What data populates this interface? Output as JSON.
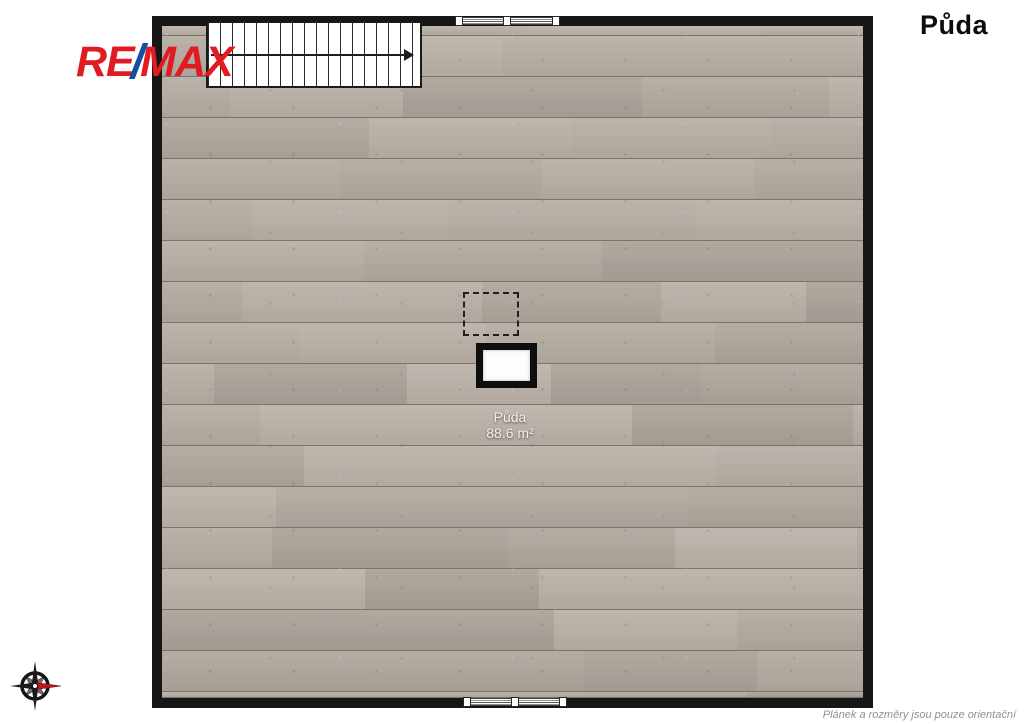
{
  "page": {
    "background": "#ffffff"
  },
  "header": {
    "title": "Půda"
  },
  "logo": {
    "re": "RE",
    "slash": "/",
    "max": "MAX",
    "color_red": "#e11b22",
    "color_blue": "#1450a0"
  },
  "room": {
    "name": "Půda",
    "area": "88.6 m²"
  },
  "floorplan": {
    "wall_color": "#161616",
    "floor_color": "#b3aba1",
    "plank_palette": [
      "#b7afa5",
      "#b2aaa0",
      "#b9b1a7",
      "#afa79d",
      "#b5ada3",
      "#bbb3a9",
      "#aba399"
    ],
    "stairs": {
      "steps": 18,
      "direction": "right"
    },
    "windows": {
      "top_segments": 2,
      "bottom_segments": 2
    }
  },
  "icons": {
    "compass": "compass-rose-icon",
    "stairs_arrow": "arrow-right-icon"
  },
  "footer": {
    "disclaimer": "Plánek a rozměry jsou pouze orientační"
  }
}
